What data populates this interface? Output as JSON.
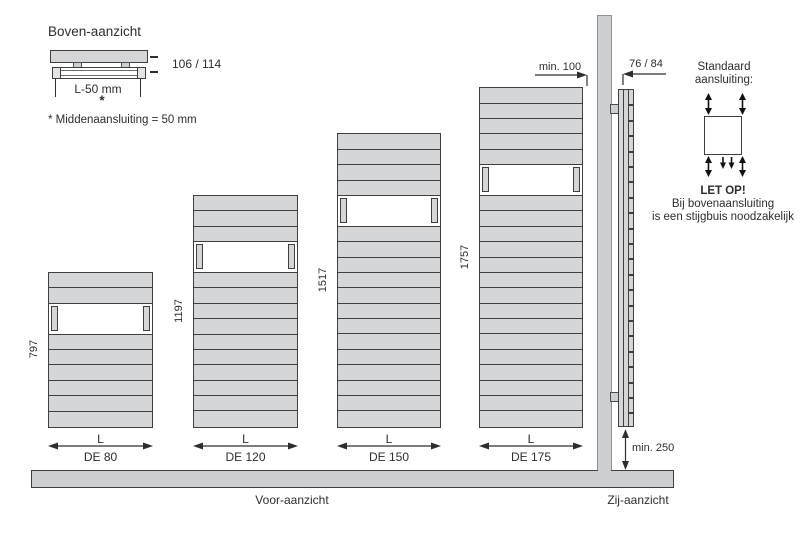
{
  "top_view": {
    "title": "Boven-aanzicht",
    "depth_dimension": "106 / 114",
    "length_dimension": "L-50 mm",
    "asterisk": "*",
    "footnote": "* Middenaansluiting = 50 mm"
  },
  "front_view": {
    "caption": "Voor-aanzicht",
    "length_label": "L",
    "radiators": [
      {
        "model": "DE 80",
        "height": "797",
        "slats_above": 2,
        "slats_below": 6
      },
      {
        "model": "DE 120",
        "height": "1197",
        "slats_above": 3,
        "slats_below": 10
      },
      {
        "model": "DE 150",
        "height": "1517",
        "slats_above": 4,
        "slats_below": 13
      },
      {
        "model": "DE 175",
        "height": "1757",
        "slats_above": 5,
        "slats_below": 15
      }
    ]
  },
  "side_view": {
    "caption": "Zij-aanzicht",
    "wall_distance": "min. 100",
    "depth_dimension": "76 / 84",
    "floor_distance": "min. 250"
  },
  "connection": {
    "label_line1": "Standaard",
    "label_line2": "aansluiting:",
    "warning_title": "LET OP!",
    "warning_line1": "Bij bovenaansluiting",
    "warning_line2": "is een stijgbuis noodzakelijk"
  },
  "colors": {
    "radiator_fill": "#d4d6d7",
    "outline": "#3f3f3f",
    "wall_floor_fill": "#ccd0d1",
    "text": "#2e2e2e"
  }
}
